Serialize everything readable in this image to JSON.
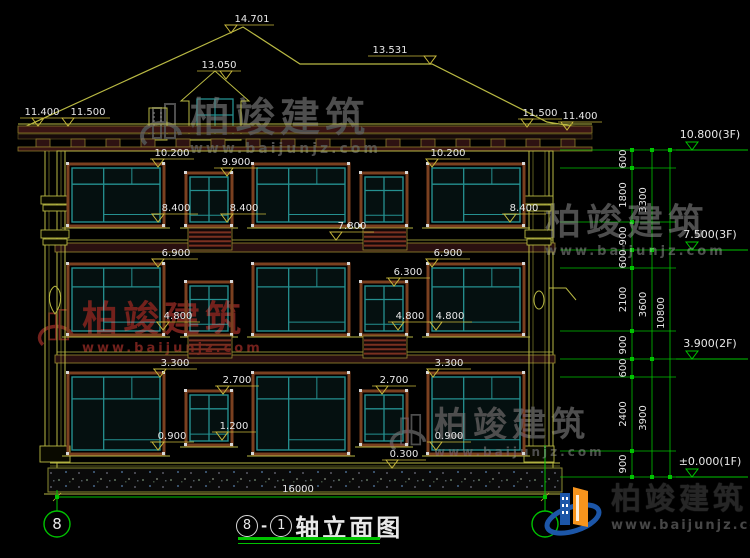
{
  "drawing": {
    "title": {
      "axis_from": "8",
      "separator": "-",
      "axis_to": "1",
      "name": "轴立面图"
    },
    "axis_bubbles": {
      "left": "8",
      "right": "1"
    },
    "elevation_markers": [
      {
        "id": "roof-peak",
        "value": "14.701"
      },
      {
        "id": "roof-ridge-right",
        "value": "13.531"
      },
      {
        "id": "dormer-peak",
        "value": "13.050"
      },
      {
        "id": "eave-left-outer",
        "value": "11.400"
      },
      {
        "id": "eave-left-inner",
        "value": "11.500"
      },
      {
        "id": "eave-right-inner",
        "value": "11.500"
      },
      {
        "id": "eave-right-outer",
        "value": "11.400"
      },
      {
        "id": "3f-window-left-top",
        "value": "10.200"
      },
      {
        "id": "3f-window-small-top",
        "value": "9.900"
      },
      {
        "id": "3f-window-right-top",
        "value": "10.200"
      },
      {
        "id": "3f-window-left-sill",
        "value": "8.400"
      },
      {
        "id": "3f-window-small-sill",
        "value": "8.400"
      },
      {
        "id": "3f-window-right-sill",
        "value": "8.400"
      },
      {
        "id": "2f-band-top",
        "value": "7.800"
      },
      {
        "id": "2f-window-left-top",
        "value": "6.900"
      },
      {
        "id": "2f-window-right-top",
        "value": "6.900"
      },
      {
        "id": "2f-window-small-top",
        "value": "6.300"
      },
      {
        "id": "2f-window-left-sill",
        "value": "4.800"
      },
      {
        "id": "2f-window-small-sill",
        "value": "4.800"
      },
      {
        "id": "2f-window-right-sill",
        "value": "4.800"
      },
      {
        "id": "1f-window-left-top",
        "value": "3.300"
      },
      {
        "id": "1f-window-right-top",
        "value": "3.300"
      },
      {
        "id": "1f-window-small-left-top",
        "value": "2.700"
      },
      {
        "id": "1f-window-small-right-top",
        "value": "2.700"
      },
      {
        "id": "1f-window-small-left-sill",
        "value": "1.200"
      },
      {
        "id": "1f-window-left-sill",
        "value": "0.900"
      },
      {
        "id": "1f-window-right-sill",
        "value": "0.900"
      },
      {
        "id": "plinth-top",
        "value": "0.300"
      }
    ],
    "right_dimensions": {
      "segments": [
        "600",
        "1800",
        "900",
        "600",
        "2100",
        "900",
        "600",
        "2400",
        "900"
      ],
      "floors": [
        "3300",
        "3600",
        "3900"
      ],
      "total": "10800"
    },
    "bottom_dimension": "16000",
    "level_marks": [
      "10.800(3F)",
      "7.500(3F)",
      "3.900(2F)",
      "±0.000(1F)"
    ]
  },
  "watermark": {
    "brand": "柏竣建筑",
    "url": "www.baijunjz.com"
  },
  "logo": {
    "brand": "柏竣建筑",
    "url": "www.baijunjz.com"
  },
  "colors": {
    "line_yellow": "#B9B943",
    "line_green": "#00C300",
    "line_teal": "#259090",
    "frame_brown": "#7A4020",
    "marker_yellow": "#C8B83C",
    "text_white": "#E8E8E8",
    "watermark_red": "#73211C",
    "watermark_gray": "#4E4E4E",
    "logo_blue": "#1C56A8",
    "logo_orange": "#F7941D"
  }
}
